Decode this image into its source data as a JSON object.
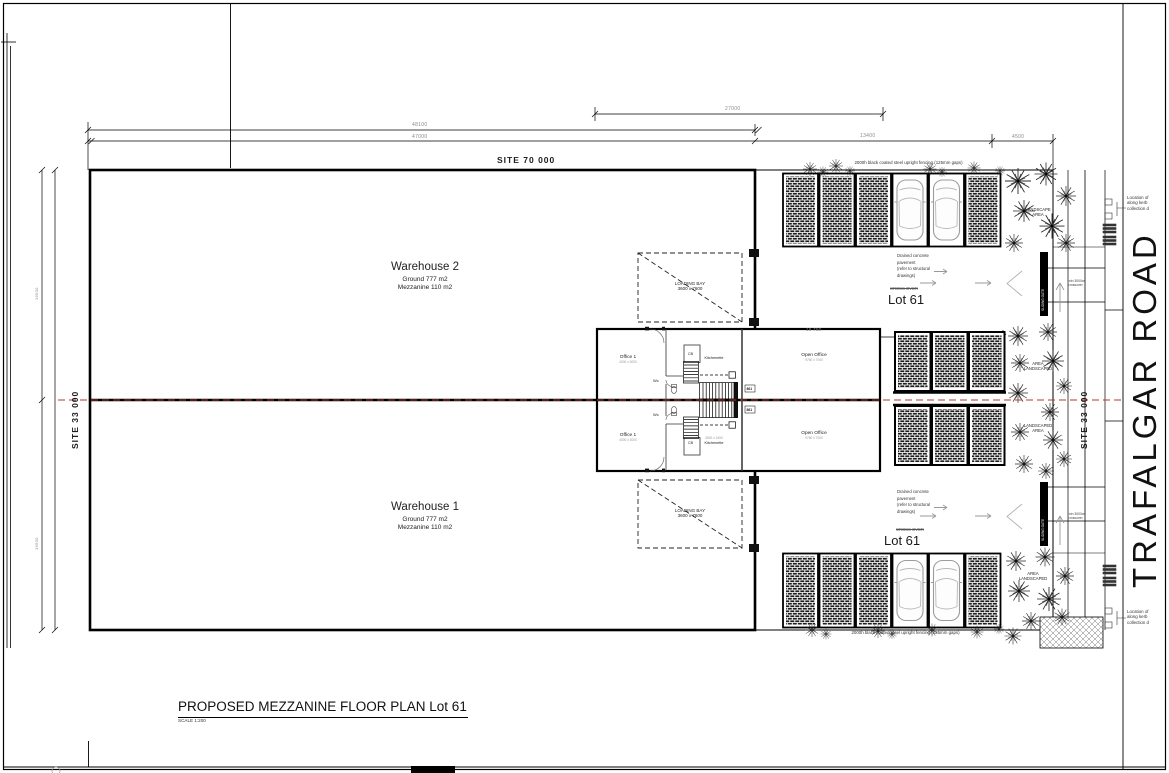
{
  "drawing": {
    "title": "PROPOSED MEZZANINE FLOOR PLAN Lot 61",
    "scale": "SCALE 1:200",
    "road_name": "TRAFALGAR ROAD",
    "site_width": "SITE   70 000",
    "site_depth": "SITE   33 000"
  },
  "dimensions": {
    "d27000": "27000",
    "d48100": "48100",
    "d47000": "47000",
    "d13400": "13400",
    "d4500": "4500",
    "d18750": "18 750",
    "d16500": "16500"
  },
  "warehouse2": {
    "name": "Warehouse 2",
    "ground": "Ground 777 m2",
    "mezzanine": "Mezzanine 110 m2"
  },
  "warehouse1": {
    "name": "Warehouse 1",
    "ground": "Ground 777 m2",
    "mezzanine": "Mezzanine 110 m2"
  },
  "loading_bay": {
    "line1": "LOADING BAY",
    "line2": "3600 x 7600"
  },
  "office": {
    "office1": "Office 1",
    "office1_size": "4000 x 3000",
    "kitchenette": "Kitchenette",
    "kitchenette_size": "3600 x 2400",
    "open_office": "Open Office",
    "open_office_size": "9760 x 7000",
    "wc": "Wc",
    "cb": "CB",
    "unit_tag": "861"
  },
  "lot": {
    "label": "Lot 61",
    "struck_note": "CROSS OVER"
  },
  "notes": {
    "pavement": [
      "Drained concrete",
      "pavement",
      "(refer to structural",
      "drawings)"
    ],
    "fencing": "2000h black coated steel upright fencing (125mm gaps)",
    "crossover": [
      "min 3000w",
      "crossover"
    ],
    "kerb_location": [
      "Location of",
      "along kerb",
      "collection d"
    ],
    "gate": "SLIDING GATE"
  },
  "landscape": {
    "top_right": [
      "LANDSCAPE",
      "AREA"
    ],
    "mid_upper": [
      "AREA",
      "LANDSCAPED"
    ],
    "mid_lower": [
      "LANDSCAPED",
      "AREA"
    ],
    "bottom_right": [
      "AREA",
      "LANDSCAPED"
    ]
  },
  "colors": {
    "centerline": "#b03a2e",
    "linework": "#000000",
    "dim_text": "#8a8a8a"
  }
}
